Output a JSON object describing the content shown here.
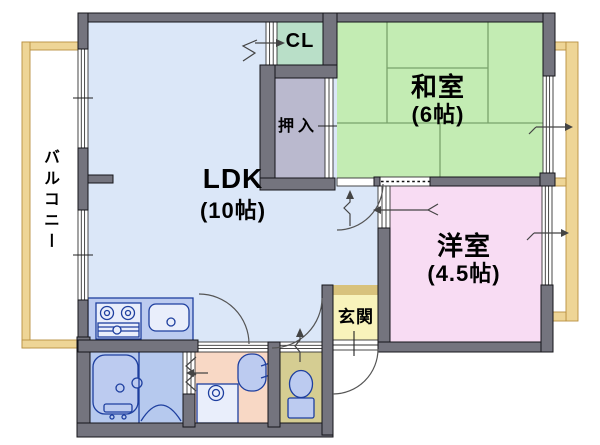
{
  "rooms": {
    "balcony": {
      "label": "バルコニー"
    },
    "ldk": {
      "label": "LDK",
      "size": "(10帖)"
    },
    "cl": {
      "label": "CL"
    },
    "oshiire": {
      "label": "押入"
    },
    "washitsu": {
      "label": "和室",
      "size": "(6帖)"
    },
    "youshitsu": {
      "label": "洋室",
      "size": "(4.5帖)"
    },
    "genkan": {
      "label": "玄関"
    }
  },
  "colors": {
    "wall": "#74747e",
    "ldk": "#dbe7f8",
    "washitsu": "#c3ecb3",
    "tatami_line": "#79a36b",
    "cl": "#b9dfc8",
    "oshiire": "#bab9ce",
    "youshitsu": "#f8dcf3",
    "genkan": "#f8f3bb",
    "genkan_step": "#d8c27c",
    "washroom": "#f8d8c5",
    "toilet_room": "#d5cd92",
    "bathroom": "#b6c9ee",
    "fixture_fill": "#bccbf0",
    "fixture_fill_light": "#e9eefb",
    "fixture_stroke": "#1e3f9f",
    "balcony_frame": "#eed596",
    "balcony_frame_border": "#b89040",
    "text": "#000000"
  }
}
